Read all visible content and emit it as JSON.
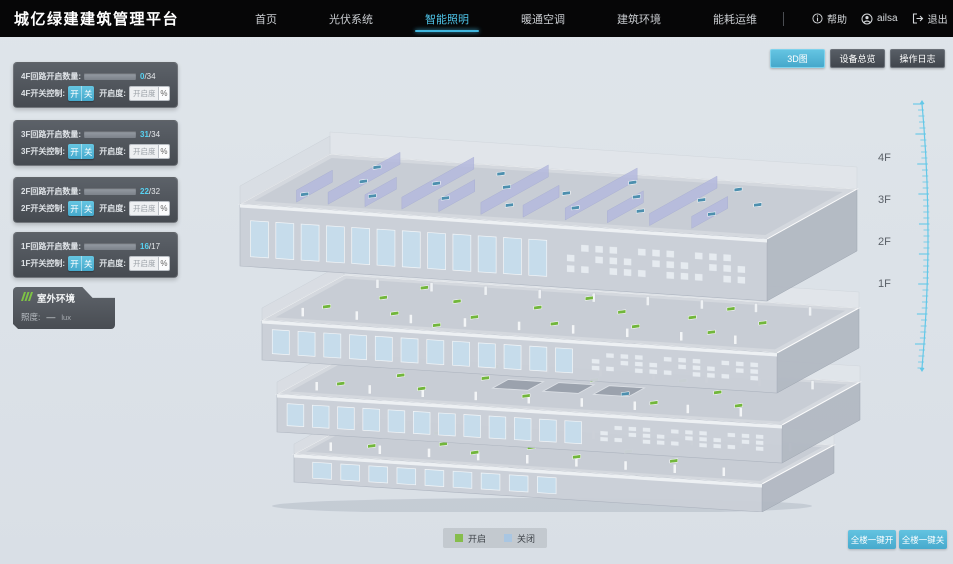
{
  "header": {
    "title": "城亿绿建建筑管理平台",
    "nav": [
      {
        "label": "首页",
        "active": false
      },
      {
        "label": "光伏系统",
        "active": false
      },
      {
        "label": "智能照明",
        "active": true
      },
      {
        "label": "暖通空调",
        "active": false
      },
      {
        "label": "建筑环境",
        "active": false
      },
      {
        "label": "能耗运维",
        "active": false
      }
    ],
    "help": "帮助",
    "user": "ailsa",
    "logout": "退出"
  },
  "toolbar": {
    "view_3d": "3D图",
    "device_overview": "设备总览",
    "operation_log": "操作日志"
  },
  "floor_panels": [
    {
      "count_label": "4F回路开启数量:",
      "open": "0",
      "total": "/34",
      "fill_pct": "0%",
      "switch_label": "4F开关控制:",
      "on_label": "开",
      "off_label": "关",
      "dim_label": "开启度:",
      "dim_placeholder": "开启度",
      "percent_label": "%"
    },
    {
      "count_label": "3F回路开启数量:",
      "open": "31",
      "total": "/34",
      "fill_pct": "91%",
      "switch_label": "3F开关控制:",
      "on_label": "开",
      "off_label": "关",
      "dim_label": "开启度:",
      "dim_placeholder": "开启度",
      "percent_label": "%"
    },
    {
      "count_label": "2F回路开启数量:",
      "open": "22",
      "total": "/32",
      "fill_pct": "88%",
      "switch_label": "2F开关控制:",
      "on_label": "开",
      "off_label": "关",
      "dim_label": "开启度:",
      "dim_placeholder": "开启度",
      "percent_label": "%"
    },
    {
      "count_label": "1F回路开启数量:",
      "open": "16",
      "total": "/17",
      "fill_pct": "94%",
      "switch_label": "1F开关控制:",
      "on_label": "开",
      "off_label": "关",
      "dim_label": "开启度:",
      "dim_placeholder": "开启度",
      "percent_label": "%"
    }
  ],
  "outdoor": {
    "title": "室外环境",
    "metric_label": "照度:",
    "metric_value": "—",
    "metric_unit": "lux"
  },
  "scene": {
    "floor_labels": [
      "4F",
      "3F",
      "2F",
      "1F"
    ]
  },
  "legend": {
    "on": {
      "label": "开启",
      "color": "#86bd4c"
    },
    "off": {
      "label": "关闭",
      "color": "#a9c6e2"
    }
  },
  "bulk": {
    "all_on": "全楼一键开",
    "all_off": "全楼一键关"
  },
  "colors": {
    "accent": "#55b9d9",
    "light_on_dot": "#72b63c",
    "light_off_dot": "#4d8fae"
  }
}
